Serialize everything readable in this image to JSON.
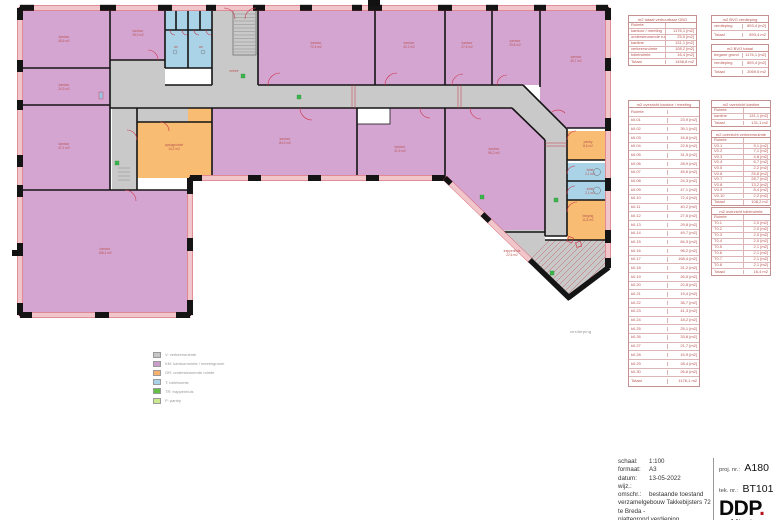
{
  "plan": {
    "floor_label": "verdieping",
    "rooms": [
      {
        "label": "kantoor",
        "area": "45,6 m2",
        "x": 64,
        "y": 38
      },
      {
        "label": "kantoor",
        "area": "24,3 m2",
        "x": 64,
        "y": 86
      },
      {
        "label": "kantoor",
        "area": "47,1 m2",
        "x": 64,
        "y": 145
      },
      {
        "label": "kantoor",
        "area": "28,9 m2",
        "x": 138,
        "y": 32
      },
      {
        "label": "wc",
        "area": "",
        "x": 176,
        "y": 48
      },
      {
        "label": "wc",
        "area": "",
        "x": 201,
        "y": 48
      },
      {
        "label": "entree",
        "area": "",
        "x": 234,
        "y": 72
      },
      {
        "label": "kantoor",
        "area": "72,4 m2",
        "x": 316,
        "y": 44
      },
      {
        "label": "kantoor",
        "area": "40,2 m2",
        "x": 409,
        "y": 44
      },
      {
        "label": "kantoor",
        "area": "27,6 m2",
        "x": 467,
        "y": 44
      },
      {
        "label": "kantoor",
        "area": "29,8 m2",
        "x": 515,
        "y": 42
      },
      {
        "label": "kantoor",
        "area": "49,7 m2",
        "x": 576,
        "y": 58
      },
      {
        "label": "opslagruimte",
        "area": "13,2 m2",
        "x": 174,
        "y": 146
      },
      {
        "label": "kantoor",
        "area": "84,3 m2",
        "x": 285,
        "y": 140
      },
      {
        "label": "kantoor",
        "area": "31,5 m2",
        "x": 400,
        "y": 148
      },
      {
        "label": "kantoor",
        "area": "96,2 m2",
        "x": 494,
        "y": 150
      },
      {
        "label": "kantoor",
        "area": "168,4 m2",
        "x": 105,
        "y": 250
      },
      {
        "label": "pantry",
        "area": "8,6 m2",
        "x": 588,
        "y": 143
      },
      {
        "label": "toilet",
        "area": "2,1 m2",
        "x": 590,
        "y": 171
      },
      {
        "label": "toilet",
        "area": "2,1 m2",
        "x": 590,
        "y": 190
      },
      {
        "label": "berging",
        "area": "11,8 m2",
        "x": 588,
        "y": 217
      },
      {
        "label": "trappenhuis",
        "area": "22,6 m2",
        "x": 512,
        "y": 252
      }
    ]
  },
  "legend": {
    "items": [
      {
        "color": "#c6c6c6",
        "label": "V: verkeersruimte"
      },
      {
        "color": "#c79fc7",
        "label": "KM: kantoorruimte / meetingroom"
      },
      {
        "color": "#f5b26c",
        "label": "OR: ondersteunende ruimte"
      },
      {
        "color": "#a9d2e9",
        "label": "T: toiletruimte"
      },
      {
        "color": "#66bf45",
        "label": "TR: trappenhuis"
      },
      {
        "color": "#cbe88e",
        "label": "P: pantry"
      }
    ]
  },
  "tables": {
    "gbo": {
      "title": "m2 totaal verhuurbaar GBO",
      "rows": [
        [
          "Ruimte",
          ""
        ],
        [
          "kantoor / meeting",
          "1176,1 [m2]"
        ],
        [
          "ondersteunende ruimte",
          "25,0 [m2]"
        ],
        [
          "kantine",
          "131,1 [m2]"
        ],
        [
          "verkeersruimte",
          "108,2 [m2]"
        ],
        [
          "toiletruimte",
          "16,4 [m2]"
        ],
        [
          "Totaal",
          "1456,8 m2"
        ]
      ]
    },
    "bvo_verdieping": {
      "title": "m2 BVO verdieping",
      "rows": [
        [
          "verdieping",
          "893,4 [m2]"
        ],
        [
          "Totaal",
          "893,4 m2"
        ]
      ]
    },
    "bvo_totaal": {
      "title": "m2 BVO totaal",
      "rows": [
        [
          "begane grond",
          "1176,1 [m2]"
        ],
        [
          "verdieping",
          "893,4 [m2]"
        ],
        [
          "Totaal",
          "2069,5 m2"
        ]
      ]
    },
    "kantoren": {
      "title": "m2 overzicht kantoor / meeting",
      "rows": [
        [
          "Ruimte",
          ""
        ],
        [
          "k0.01",
          "23,9 [m2]"
        ],
        [
          "k0.02",
          "39,1 [m2]"
        ],
        [
          "k0.03",
          "16,8 [m2]"
        ],
        [
          "k0.04",
          "22,6 [m2]"
        ],
        [
          "k0.05",
          "31,5 [m2]"
        ],
        [
          "k0.06",
          "28,9 [m2]"
        ],
        [
          "k0.07",
          "45,6 [m2]"
        ],
        [
          "k0.08",
          "24,3 [m2]"
        ],
        [
          "k0.09",
          "47,1 [m2]"
        ],
        [
          "k0.10",
          "72,4 [m2]"
        ],
        [
          "k0.11",
          "40,2 [m2]"
        ],
        [
          "k0.12",
          "27,6 [m2]"
        ],
        [
          "k0.13",
          "29,8 [m2]"
        ],
        [
          "k0.14",
          "49,7 [m2]"
        ],
        [
          "k0.15",
          "84,3 [m2]"
        ],
        [
          "k0.16",
          "96,2 [m2]"
        ],
        [
          "k0.17",
          "168,4 [m2]"
        ],
        [
          "k0.18",
          "31,2 [m2]"
        ],
        [
          "k0.19",
          "26,5 [m2]"
        ],
        [
          "k0.20",
          "22,8 [m2]"
        ],
        [
          "k0.21",
          "19,4 [m2]"
        ],
        [
          "k0.22",
          "36,7 [m2]"
        ],
        [
          "k0.23",
          "41,3 [m2]"
        ],
        [
          "k0.24",
          "18,2 [m2]"
        ],
        [
          "k0.25",
          "25,1 [m2]"
        ],
        [
          "k0.26",
          "33,8 [m2]"
        ],
        [
          "k0.27",
          "21,7 [m2]"
        ],
        [
          "k0.28",
          "15,9 [m2]"
        ],
        [
          "k0.29",
          "28,4 [m2]"
        ],
        [
          "k0.30",
          "26,6 [m2]"
        ],
        [
          "Totaal",
          "1176,1 m2"
        ]
      ]
    },
    "kantine": {
      "title": "m2 overzicht kantine",
      "rows": [
        [
          "Ruimte",
          ""
        ],
        [
          "kantine",
          "131,1 [m2]"
        ],
        [
          "Totaal",
          "131,1 m2"
        ]
      ]
    },
    "verkeer": {
      "title": "m2 overzicht verkeersruimte",
      "rows": [
        [
          "Ruimte",
          ""
        ],
        [
          "V0.1",
          "9,1 [m2]"
        ],
        [
          "V0.2",
          "7,1 [m2]"
        ],
        [
          "V0.3",
          "4,8 [m2]"
        ],
        [
          "V0.4",
          "6,7 [m2]"
        ],
        [
          "V0.5",
          "2,2 [m2]"
        ],
        [
          "V0.6",
          "25,8 [m2]"
        ],
        [
          "V0.7",
          "28,7 [m2]"
        ],
        [
          "V0.8",
          "13,2 [m2]"
        ],
        [
          "V0.9",
          "8,4 [m2]"
        ],
        [
          "V0.10",
          "2,2 [m2]"
        ],
        [
          "Totaal",
          "108,2 m2"
        ]
      ]
    },
    "toilet": {
      "title": "m2 overzicht toiletruimte",
      "rows": [
        [
          "Ruimte",
          ""
        ],
        [
          "T0.1",
          "2,0 [m2]"
        ],
        [
          "T0.2",
          "2,0 [m2]"
        ],
        [
          "T0.3",
          "2,0 [m2]"
        ],
        [
          "T0.4",
          "2,0 [m2]"
        ],
        [
          "T0.5",
          "2,1 [m2]"
        ],
        [
          "T0.6",
          "2,1 [m2]"
        ],
        [
          "T0.7",
          "2,1 [m2]"
        ],
        [
          "T0.8",
          "2,1 [m2]"
        ],
        [
          "Totaal",
          "16,4 m2"
        ]
      ]
    }
  },
  "titleblock": {
    "schaal_label": "schaal:",
    "schaal": "1:100",
    "formaat_label": "formaat:",
    "formaat": "A3",
    "datum_label": "datum:",
    "datum": "13-05-2022",
    "wijz_label": "wijz.:",
    "omschr_label": "omschr.:",
    "omschr1": "bestaande toestand",
    "omschr2": "verzamelgebouw Takkebijsters 72",
    "omschr3": "te Breda -",
    "omschr4": "plattegrond verdieping",
    "proj_label": "proj. nr.:",
    "proj": "A180",
    "tek_label": "tek. nr.:",
    "tek": "BT101",
    "logo": "DDP",
    "logo_dot": ".",
    "logo_sub": "architectuur"
  },
  "colors": {
    "office": "#d5a5d2",
    "circulation": "#c9c9c9",
    "support": "#f8bc72",
    "toilet": "#aad3e8",
    "accent_red": "#cc3344",
    "accent_green": "#3ab54a",
    "table_text": "#b85450",
    "logo_dot": "#b5121b"
  }
}
